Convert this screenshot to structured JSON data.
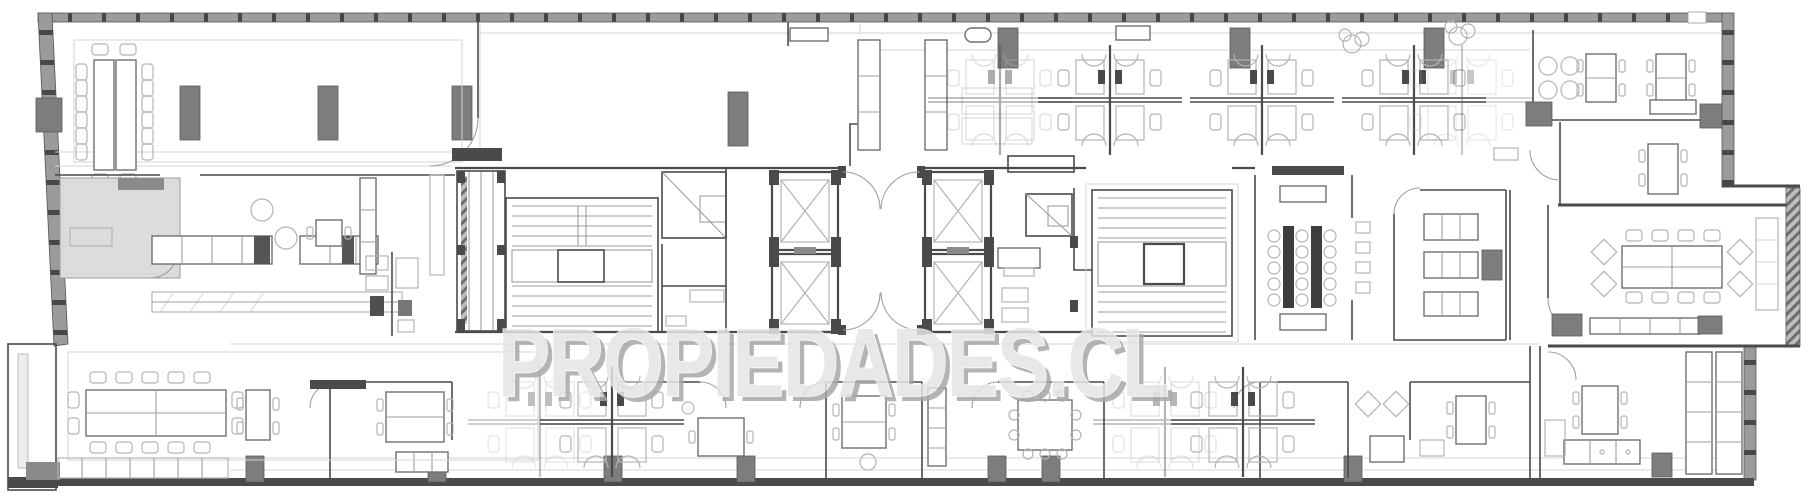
{
  "meta": {
    "kind": "architectural floor plan",
    "description": "Grayscale CAD floor plan of one elongated office building level with central elevator-and-stair core, open-plan workstations, perimeter offices and conference rooms"
  },
  "watermark": {
    "text": "PROPIEDADES.CL"
  },
  "palette": {
    "background": "#ffffff",
    "wall_dark": "#4a4a4a",
    "wall_mid": "#8a8a8a",
    "column_fill": "#7d7d7d",
    "line_light": "#d4d4d4",
    "line_mid": "#9f9f9f",
    "furniture_stroke": "#6f6f6f",
    "furniture_light": "#b3b3b3",
    "room_shade": "#dcdcdc",
    "table_dark": "#3d3d3d",
    "watermark_fill": "#e4e4e4",
    "watermark_shadow": "#a8a8a8"
  },
  "zones": [
    {
      "id": "conference-room-nw",
      "symbols": "double long table with perimeter chairs"
    },
    {
      "id": "kitchen-service-area",
      "symbols": "shaded pantry room, counters, round tables, wc fixtures"
    },
    {
      "id": "core-west",
      "symbols": "service shafts, scissor stair, two elevator shafts, lobby double doors"
    },
    {
      "id": "core-east",
      "symbols": "two elevator shafts, wc rooms, scissor stair"
    },
    {
      "id": "open-office-north",
      "symbols": "cross-shaped workstation clusters with chairs, storage columns, plants"
    },
    {
      "id": "focus-room-center",
      "symbols": "two dark high tables with stool rings, cabinets"
    },
    {
      "id": "lounge-center",
      "symbols": "three sofas and media unit"
    },
    {
      "id": "offices-ne",
      "symbols": "two private offices with desks and round table"
    },
    {
      "id": "conference-room-e",
      "symbols": "long boardroom table, corner lounge chairs, sideboard"
    },
    {
      "id": "offices-south",
      "symbols": "row of private offices, meeting nooks, workstations"
    },
    {
      "id": "conference-room-sw",
      "symbols": "long table with chairs, locker band"
    },
    {
      "id": "structure",
      "symbols": "curtain-wall mullion band, concrete columns, hatched party walls"
    }
  ]
}
